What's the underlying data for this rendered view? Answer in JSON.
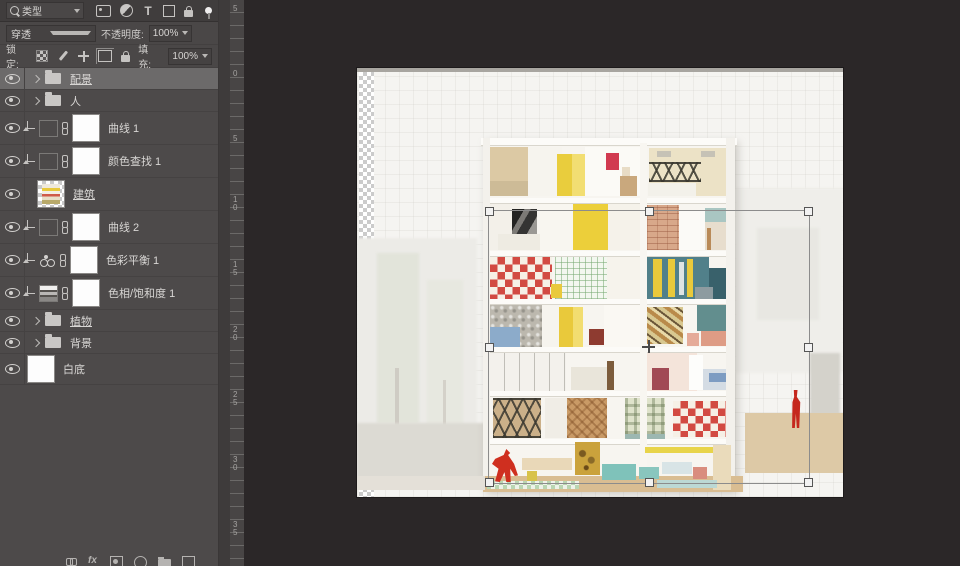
{
  "panel": {
    "filter": {
      "kind_label": "类型",
      "icons": [
        {
          "dn": "pixel-filter-icon",
          "cls": "ico-img"
        },
        {
          "dn": "adjustment-filter-icon",
          "cls": "ico-adj"
        },
        {
          "dn": "type-filter-icon",
          "cls": "ico-type",
          "t": "T"
        },
        {
          "dn": "shape-filter-icon",
          "cls": "ico-shape"
        },
        {
          "dn": "smartobject-filter-icon",
          "cls": "ico-lock"
        }
      ]
    },
    "blend": {
      "mode": "穿透",
      "opacity_label": "不透明度:",
      "opacity_value": "100%"
    },
    "lock": {
      "label": "锁定:",
      "icons": [
        {
          "dn": "lock-transparent-icon",
          "cls": "ico-checker"
        },
        {
          "dn": "lock-paint-icon",
          "cls": "ico-brush"
        },
        {
          "dn": "lock-move-icon",
          "cls": "ico-move"
        },
        {
          "dn": "lock-artboard-icon",
          "cls": "ico-artboard"
        },
        {
          "dn": "lock-all-icon",
          "cls": "ico-lock-s"
        }
      ],
      "fill_label": "填充:",
      "fill_value": "100%"
    },
    "layers": [
      {
        "name": "配景",
        "cls": "group selected u",
        "dn": "layer-row-peijing-group"
      },
      {
        "name": "人",
        "cls": "group",
        "dn": "layer-row-ren-group"
      },
      {
        "name": "曲线 1",
        "cls": "adj curves",
        "dn": "layer-row-curves-1"
      },
      {
        "name": "颜色查找 1",
        "cls": "adj lut",
        "dn": "layer-row-colorlookup-1"
      },
      {
        "name": "建筑",
        "cls": "image u",
        "dn": "layer-row-jianzhu"
      },
      {
        "name": "曲线 2",
        "cls": "adj curves",
        "dn": "layer-row-curves-2"
      },
      {
        "name": "色彩平衡 1",
        "cls": "adj balance",
        "dn": "layer-row-colorbalance-1"
      },
      {
        "name": "色相/饱和度 1",
        "cls": "adj huesat",
        "dn": "layer-row-huesaturation-1"
      },
      {
        "name": "植物",
        "cls": "group u",
        "dn": "layer-row-zhiwu-group"
      },
      {
        "name": "背景",
        "cls": "group",
        "dn": "layer-row-beijing-group"
      },
      {
        "name": "白底",
        "cls": "fill",
        "dn": "layer-row-baidi"
      }
    ],
    "bottom_icons": [
      {
        "dn": "link-layers-icon",
        "cls": "bico chainb"
      },
      {
        "dn": "layer-effects-icon",
        "cls": "bico fx",
        "t": "fx"
      },
      {
        "dn": "add-mask-icon",
        "cls": "bico maskb"
      },
      {
        "dn": "new-adjustment-icon",
        "cls": "bico round"
      },
      {
        "dn": "new-group-icon",
        "cls": "bico folderb"
      },
      {
        "dn": "delete-layer-icon",
        "cls": "bico"
      }
    ]
  },
  "ruler": {
    "labels": [
      {
        "t": "5",
        "y": 5
      },
      {
        "t": "0",
        "y": 70
      },
      {
        "t": "5",
        "y": 135
      },
      {
        "t": "10",
        "y": 196
      },
      {
        "t": "15",
        "y": 261
      },
      {
        "t": "20",
        "y": 326
      },
      {
        "t": "25",
        "y": 391
      },
      {
        "t": "30",
        "y": 456
      },
      {
        "t": "35",
        "y": 521
      }
    ]
  },
  "transform": {
    "x": 131,
    "y": 142,
    "w": 320,
    "h": 272
  },
  "colors": {
    "panel_bg": "#4d4a4a",
    "canvas_bg": "#2b2728",
    "selection_row": "#6c6a6a",
    "paper": "#f5f4f1",
    "accent_red": "#d13a50",
    "accent_yellow": "#e9c93b",
    "accent_teal": "#51808a"
  },
  "artwork": {
    "blocks": [
      {
        "dn": "bg-left-field",
        "x": 0,
        "y": 170,
        "w": 120,
        "h": 240,
        "c": "#ecebe7",
        "cls": "soft"
      },
      {
        "dn": "bg-tree",
        "x": 20,
        "y": 185,
        "w": 42,
        "h": 170,
        "c": "#e2e4da",
        "cls": "soft"
      },
      {
        "dn": "bg-tree",
        "x": 70,
        "y": 212,
        "w": 36,
        "h": 145,
        "c": "#e7e8e0",
        "cls": "soft"
      },
      {
        "dn": "bg-tree-trunk",
        "x": 38,
        "y": 300,
        "w": 4,
        "h": 82,
        "c": "#cfccc4"
      },
      {
        "dn": "bg-tree-trunk",
        "x": 86,
        "y": 312,
        "w": 3,
        "h": 62,
        "c": "#d4d1c9"
      },
      {
        "dn": "bg-ground-left",
        "x": 0,
        "y": 355,
        "w": 128,
        "h": 56,
        "c": "#dcdad3",
        "cls": "soft"
      },
      {
        "dn": "bg-city-right",
        "x": 378,
        "y": 120,
        "w": 108,
        "h": 185,
        "c": "#efeeea",
        "cls": "soft"
      },
      {
        "dn": "bg-city-right",
        "x": 400,
        "y": 160,
        "w": 62,
        "h": 92,
        "c": "#e8e7e2",
        "cls": "soft"
      },
      {
        "dn": "bg-boulder",
        "x": 453,
        "y": 285,
        "w": 30,
        "h": 88,
        "c": "#d4d2cb",
        "cls": "soft"
      },
      {
        "dn": "bg-deck-right",
        "x": 388,
        "y": 345,
        "w": 98,
        "h": 60,
        "c": "#ddc9a6"
      },
      {
        "dn": "building-body",
        "x": 126,
        "y": 70,
        "w": 252,
        "h": 352,
        "c": "#f7f5f0",
        "cls": "bodyshadow"
      },
      {
        "dn": "room-wardrobe",
        "x": 133,
        "y": 79,
        "w": 38,
        "h": 44,
        "c": "#dcc9a4"
      },
      {
        "dn": "room-bed",
        "x": 133,
        "y": 113,
        "w": 50,
        "h": 15,
        "c": "#cdbb97"
      },
      {
        "dn": "room-wall",
        "x": 171,
        "y": 79,
        "w": 34,
        "h": 49,
        "c": "#f6f4ee"
      },
      {
        "dn": "room-yellow-cabinet",
        "x": 200,
        "y": 86,
        "w": 15,
        "h": 42,
        "c": "#e9cd3d"
      },
      {
        "dn": "room-yellow-cabinet",
        "x": 215,
        "y": 86,
        "w": 13,
        "h": 42,
        "c": "#f2de72"
      },
      {
        "dn": "room-wall",
        "x": 228,
        "y": 79,
        "w": 55,
        "h": 49,
        "c": "#fbfaf6"
      },
      {
        "dn": "deer-head",
        "x": 249,
        "y": 85,
        "w": 13,
        "h": 17,
        "c": "#d13a50"
      },
      {
        "dn": "mirror",
        "x": 265,
        "y": 99,
        "w": 8,
        "h": 10,
        "c": "#e8dcc6"
      },
      {
        "dn": "dresser",
        "x": 263,
        "y": 108,
        "w": 17,
        "h": 20,
        "c": "#c9a87d"
      },
      {
        "dn": "room-shelf-wall",
        "x": 292,
        "y": 80,
        "w": 84,
        "h": 48,
        "c": "#ece2c6"
      },
      {
        "dn": "vent",
        "x": 300,
        "y": 83,
        "w": 14,
        "h": 6,
        "c": "#c6c2b6"
      },
      {
        "dn": "vent",
        "x": 344,
        "y": 83,
        "w": 14,
        "h": 6,
        "c": "#c6c2b6"
      },
      {
        "dn": "steel-truss",
        "x": 292,
        "y": 94,
        "w": 52,
        "h": 20,
        "cls": "trussed"
      },
      {
        "dn": "room-bed",
        "x": 291,
        "y": 115,
        "w": 48,
        "h": 13,
        "c": "#f3f1ea"
      },
      {
        "dn": "room-wall",
        "x": 133,
        "y": 136,
        "w": 30,
        "h": 46,
        "c": "#f3f0e9"
      },
      {
        "dn": "portrait-photo",
        "x": 155,
        "y": 141,
        "w": 25,
        "h": 29,
        "cls": "photo"
      },
      {
        "dn": "room-bed",
        "x": 141,
        "y": 166,
        "w": 42,
        "h": 16,
        "c": "#eeebe2"
      },
      {
        "dn": "room-wall",
        "x": 183,
        "y": 136,
        "w": 33,
        "h": 46,
        "c": "#f8f6f0"
      },
      {
        "dn": "yellow-wall",
        "x": 216,
        "y": 136,
        "w": 35,
        "h": 46,
        "c": "#eccf3a"
      },
      {
        "dn": "room-wall",
        "x": 251,
        "y": 136,
        "w": 32,
        "h": 46,
        "c": "#f5f2ea"
      },
      {
        "dn": "brick-wall",
        "x": 290,
        "y": 137,
        "w": 32,
        "h": 45,
        "c": "#d8a88a",
        "cls": "brick"
      },
      {
        "dn": "kitchen",
        "x": 322,
        "y": 143,
        "w": 26,
        "h": 39,
        "c": "#fbfaf7"
      },
      {
        "dn": "teal-panel",
        "x": 348,
        "y": 140,
        "w": 26,
        "h": 14,
        "c": "#a9c6c2"
      },
      {
        "dn": "room-bed",
        "x": 348,
        "y": 154,
        "w": 26,
        "h": 28,
        "c": "#e7ddcd"
      },
      {
        "dn": "bed-post",
        "x": 350,
        "y": 160,
        "w": 4,
        "h": 22,
        "c": "#b98a58"
      },
      {
        "dn": "checker-wall",
        "x": 133,
        "y": 189,
        "w": 62,
        "h": 42,
        "cls": "checker-red"
      },
      {
        "dn": "grid-wall",
        "x": 198,
        "y": 189,
        "w": 52,
        "h": 42,
        "cls": "grid-green"
      },
      {
        "dn": "yellow-stool",
        "x": 194,
        "y": 216,
        "w": 11,
        "h": 14,
        "c": "#e9c93b"
      },
      {
        "dn": "room-wall",
        "x": 250,
        "y": 189,
        "w": 33,
        "h": 42,
        "c": "#f6f3ec"
      },
      {
        "dn": "teal-bookwall",
        "x": 290,
        "y": 189,
        "w": 62,
        "h": 42,
        "c": "#51808a"
      },
      {
        "dn": "book-stripe",
        "x": 296,
        "y": 191,
        "w": 9,
        "h": 38,
        "c": "#e9c93b"
      },
      {
        "dn": "book-stripe",
        "x": 311,
        "y": 191,
        "w": 7,
        "h": 38,
        "c": "#e9c93b"
      },
      {
        "dn": "book-stripe",
        "x": 322,
        "y": 194,
        "w": 5,
        "h": 33,
        "c": "#dfe4e4"
      },
      {
        "dn": "book-stripe",
        "x": 330,
        "y": 191,
        "w": 6,
        "h": 38,
        "c": "#e9c93b"
      },
      {
        "dn": "dark-cabinet",
        "x": 352,
        "y": 200,
        "w": 22,
        "h": 31,
        "c": "#39616b"
      },
      {
        "dn": "gray-sofa",
        "x": 338,
        "y": 219,
        "w": 18,
        "h": 12,
        "c": "#8d9ba0"
      },
      {
        "dn": "stone-wall",
        "x": 133,
        "y": 237,
        "w": 52,
        "h": 42,
        "c": "#bcb8ae",
        "cls": "pebble"
      },
      {
        "dn": "blue-bed",
        "x": 133,
        "y": 259,
        "w": 30,
        "h": 20,
        "c": "#8cabca"
      },
      {
        "dn": "room-wall",
        "x": 185,
        "y": 237,
        "w": 30,
        "h": 42,
        "c": "#f6f4ee"
      },
      {
        "dn": "yellow-door",
        "x": 202,
        "y": 239,
        "w": 14,
        "h": 40,
        "c": "#e9c93b"
      },
      {
        "dn": "yellow-door",
        "x": 216,
        "y": 239,
        "w": 10,
        "h": 40,
        "c": "#f2dd70"
      },
      {
        "dn": "red-table",
        "x": 232,
        "y": 261,
        "w": 15,
        "h": 16,
        "c": "#8e3b30"
      },
      {
        "dn": "room-wall",
        "x": 247,
        "y": 237,
        "w": 36,
        "h": 42,
        "c": "#faf8f3"
      },
      {
        "dn": "collage-art",
        "x": 290,
        "y": 239,
        "w": 36,
        "h": 37,
        "cls": "collage"
      },
      {
        "dn": "room-wall",
        "x": 326,
        "y": 237,
        "w": 22,
        "h": 42,
        "c": "#f8f6f1"
      },
      {
        "dn": "teal-wall",
        "x": 340,
        "y": 237,
        "w": 34,
        "h": 26,
        "c": "#628e8e"
      },
      {
        "dn": "pink-sofa",
        "x": 344,
        "y": 263,
        "w": 26,
        "h": 15,
        "c": "#de9c85"
      },
      {
        "dn": "pink-chair",
        "x": 330,
        "y": 265,
        "w": 12,
        "h": 13,
        "c": "#e5ab99"
      },
      {
        "dn": "closet-wall",
        "x": 133,
        "y": 285,
        "w": 76,
        "h": 38,
        "c": "#f3f1ec",
        "cls": "closet"
      },
      {
        "dn": "room-bed",
        "x": 214,
        "y": 299,
        "w": 38,
        "h": 23,
        "c": "#e9e5da"
      },
      {
        "dn": "headboard",
        "x": 250,
        "y": 293,
        "w": 7,
        "h": 29,
        "c": "#7c5c3c"
      },
      {
        "dn": "pink-wall",
        "x": 290,
        "y": 285,
        "w": 50,
        "h": 38,
        "c": "#f4e4da"
      },
      {
        "dn": "maroon-chair",
        "x": 295,
        "y": 300,
        "w": 17,
        "h": 22,
        "c": "#a14a55"
      },
      {
        "dn": "white-door",
        "x": 332,
        "y": 287,
        "w": 14,
        "h": 35,
        "c": "#fdfdfb"
      },
      {
        "dn": "room-bed",
        "x": 346,
        "y": 301,
        "w": 28,
        "h": 21,
        "c": "#d4dce4"
      },
      {
        "dn": "blue-blanket",
        "x": 352,
        "y": 305,
        "w": 17,
        "h": 9,
        "c": "#7d9cc2"
      },
      {
        "dn": "steel-frame-wood",
        "x": 136,
        "y": 330,
        "w": 48,
        "h": 40,
        "c": "#cbb089",
        "cls": "trussed"
      },
      {
        "dn": "room-wall",
        "x": 188,
        "y": 330,
        "w": 22,
        "h": 40,
        "c": "#f0ede6"
      },
      {
        "dn": "herringbone-panel",
        "x": 210,
        "y": 330,
        "w": 40,
        "h": 40,
        "c": "#c99a66",
        "cls": "herringbone"
      },
      {
        "dn": "plaid-panel",
        "x": 268,
        "y": 330,
        "w": 40,
        "h": 36,
        "cls": "plaid"
      },
      {
        "dn": "teal-strip",
        "x": 268,
        "y": 366,
        "w": 40,
        "h": 5,
        "c": "#9cb7b1"
      },
      {
        "dn": "checker-wall",
        "x": 316,
        "y": 333,
        "w": 56,
        "h": 36,
        "cls": "checker-red"
      },
      {
        "dn": "floor-slab",
        "x": 124,
        "y": 70,
        "w": 256,
        "h": 7,
        "c": "#fcfbf8",
        "cls": "slab"
      },
      {
        "dn": "floor-slab",
        "x": 126,
        "y": 130,
        "w": 252,
        "h": 5,
        "c": "#fcfbf8",
        "cls": "slab"
      },
      {
        "dn": "floor-slab",
        "x": 126,
        "y": 183,
        "w": 252,
        "h": 5,
        "c": "#fcfbf8",
        "cls": "slab"
      },
      {
        "dn": "floor-slab",
        "x": 126,
        "y": 231,
        "w": 252,
        "h": 5,
        "c": "#fcfbf8",
        "cls": "slab"
      },
      {
        "dn": "floor-slab",
        "x": 126,
        "y": 279,
        "w": 252,
        "h": 5,
        "c": "#fcfbf8",
        "cls": "slab"
      },
      {
        "dn": "floor-slab",
        "x": 126,
        "y": 323,
        "w": 252,
        "h": 5,
        "c": "#fcfbf8",
        "cls": "slab"
      },
      {
        "dn": "floor-slab",
        "x": 126,
        "y": 371,
        "w": 252,
        "h": 5,
        "c": "#fcfbf8",
        "cls": "slab"
      },
      {
        "dn": "wall-left",
        "x": 126,
        "y": 70,
        "w": 7,
        "h": 352,
        "c": "#f3f1ec"
      },
      {
        "dn": "wall-right",
        "x": 369,
        "y": 70,
        "w": 9,
        "h": 352,
        "c": "#f3f1ec"
      },
      {
        "dn": "wall-divider",
        "x": 283,
        "y": 75,
        "w": 7,
        "h": 347,
        "c": "#f8f6f1",
        "cls": "slab"
      },
      {
        "dn": "ground-wood",
        "x": 126,
        "y": 408,
        "w": 260,
        "h": 16,
        "c": "#d9bd92"
      },
      {
        "dn": "ground-ledge",
        "x": 0,
        "y": 408,
        "w": 128,
        "h": 14,
        "c": "#e4e0d8"
      },
      {
        "dn": "floor-mat",
        "x": 130,
        "y": 413,
        "w": 92,
        "h": 8,
        "cls": "checker-green"
      },
      {
        "dn": "table",
        "x": 165,
        "y": 390,
        "w": 50,
        "h": 12,
        "c": "#e9d8b8"
      },
      {
        "dn": "stool",
        "x": 170,
        "y": 403,
        "w": 10,
        "h": 10,
        "c": "#d8c24a"
      },
      {
        "dn": "sunflower-painting",
        "x": 218,
        "y": 374,
        "w": 25,
        "h": 33,
        "c": "#caa23c",
        "cls": "sunflower"
      },
      {
        "dn": "teal-sofa",
        "x": 245,
        "y": 396,
        "w": 34,
        "h": 16,
        "c": "#7fc2ba"
      },
      {
        "dn": "teal-sofa",
        "x": 282,
        "y": 399,
        "w": 20,
        "h": 12,
        "c": "#89c6be"
      },
      {
        "dn": "yellow-strip",
        "x": 288,
        "y": 379,
        "w": 70,
        "h": 6,
        "c": "#e8d44a"
      },
      {
        "dn": "white-table",
        "x": 305,
        "y": 394,
        "w": 30,
        "h": 12,
        "c": "#d8e4e6"
      },
      {
        "dn": "pink-chair",
        "x": 336,
        "y": 399,
        "w": 14,
        "h": 12,
        "c": "#d98d7e"
      },
      {
        "dn": "wood-counter",
        "x": 356,
        "y": 377,
        "w": 18,
        "h": 45,
        "c": "#eadbbb"
      },
      {
        "dn": "pool-strip",
        "x": 300,
        "y": 412,
        "w": 60,
        "h": 8,
        "c": "#bcd8d4"
      },
      {
        "dn": "red-kangaroo-sculpture",
        "x": 135,
        "y": 381,
        "w": 26,
        "h": 33,
        "c": "#cf2f1f",
        "cls": "kangaroo"
      },
      {
        "dn": "red-figure",
        "x": 430,
        "y": 322,
        "w": 17,
        "h": 38,
        "c": "#c5271d",
        "cls": "person"
      }
    ]
  }
}
